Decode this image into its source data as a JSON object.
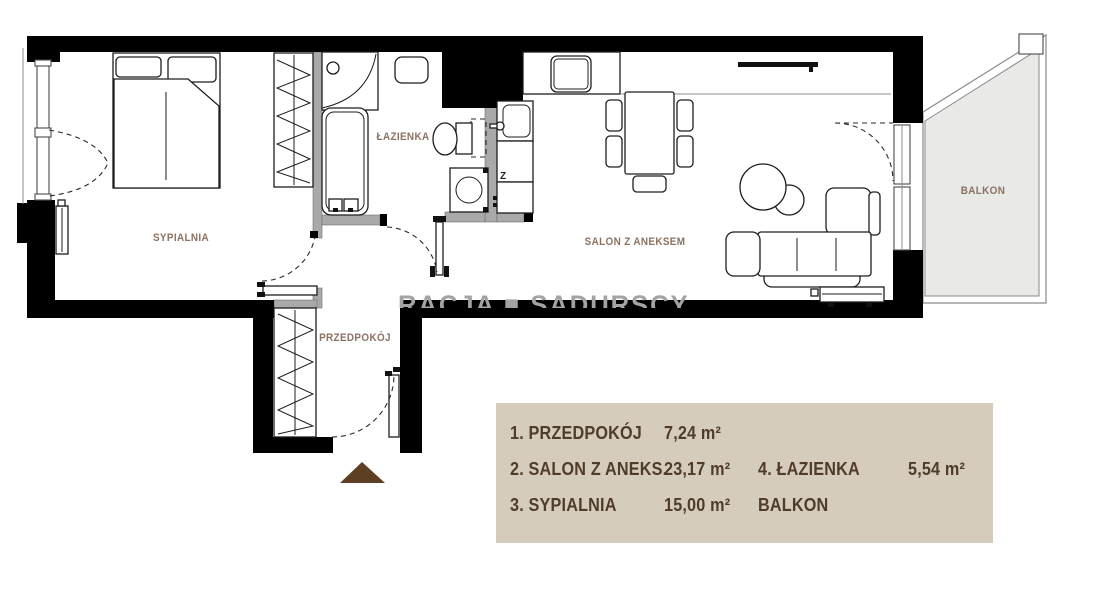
{
  "rooms": {
    "bedroom": {
      "label": "SYPIALNIA"
    },
    "bathroom": {
      "label": "ŁAZIENKA"
    },
    "living": {
      "label": "SALON Z ANEKSEM"
    },
    "hall": {
      "label": "PRZEDPOKÓJ"
    },
    "balcony": {
      "label": "BALKON"
    }
  },
  "kitchen": {
    "dishwasher_marker": "Z"
  },
  "watermark": {
    "text": "RACJA ■ SADURSCY"
  },
  "legend": {
    "rows": [
      {
        "name1": "1. PRZEDPOKÓJ",
        "area1": "7,24 m²",
        "name2": "",
        "area2": ""
      },
      {
        "name1": "2. SALON Z ANEKS.",
        "area1": "23,17 m²",
        "name2": "4. ŁAZIENKA",
        "area2": "5,54 m²"
      },
      {
        "name1": "3. SYPIALNIA",
        "area1": "15,00 m²",
        "name2": "BALKON",
        "area2": ""
      }
    ]
  },
  "colors": {
    "wall": "#000000",
    "partition": "#a9a9a9",
    "room_label": "#8b7262",
    "legend_bg": "#d6ccbe",
    "legend_text": "#4f3c29",
    "entrance_arrow": "#5d4023",
    "balcony_fill": "#e9e9e8",
    "watermark": "#a3a3a3"
  }
}
